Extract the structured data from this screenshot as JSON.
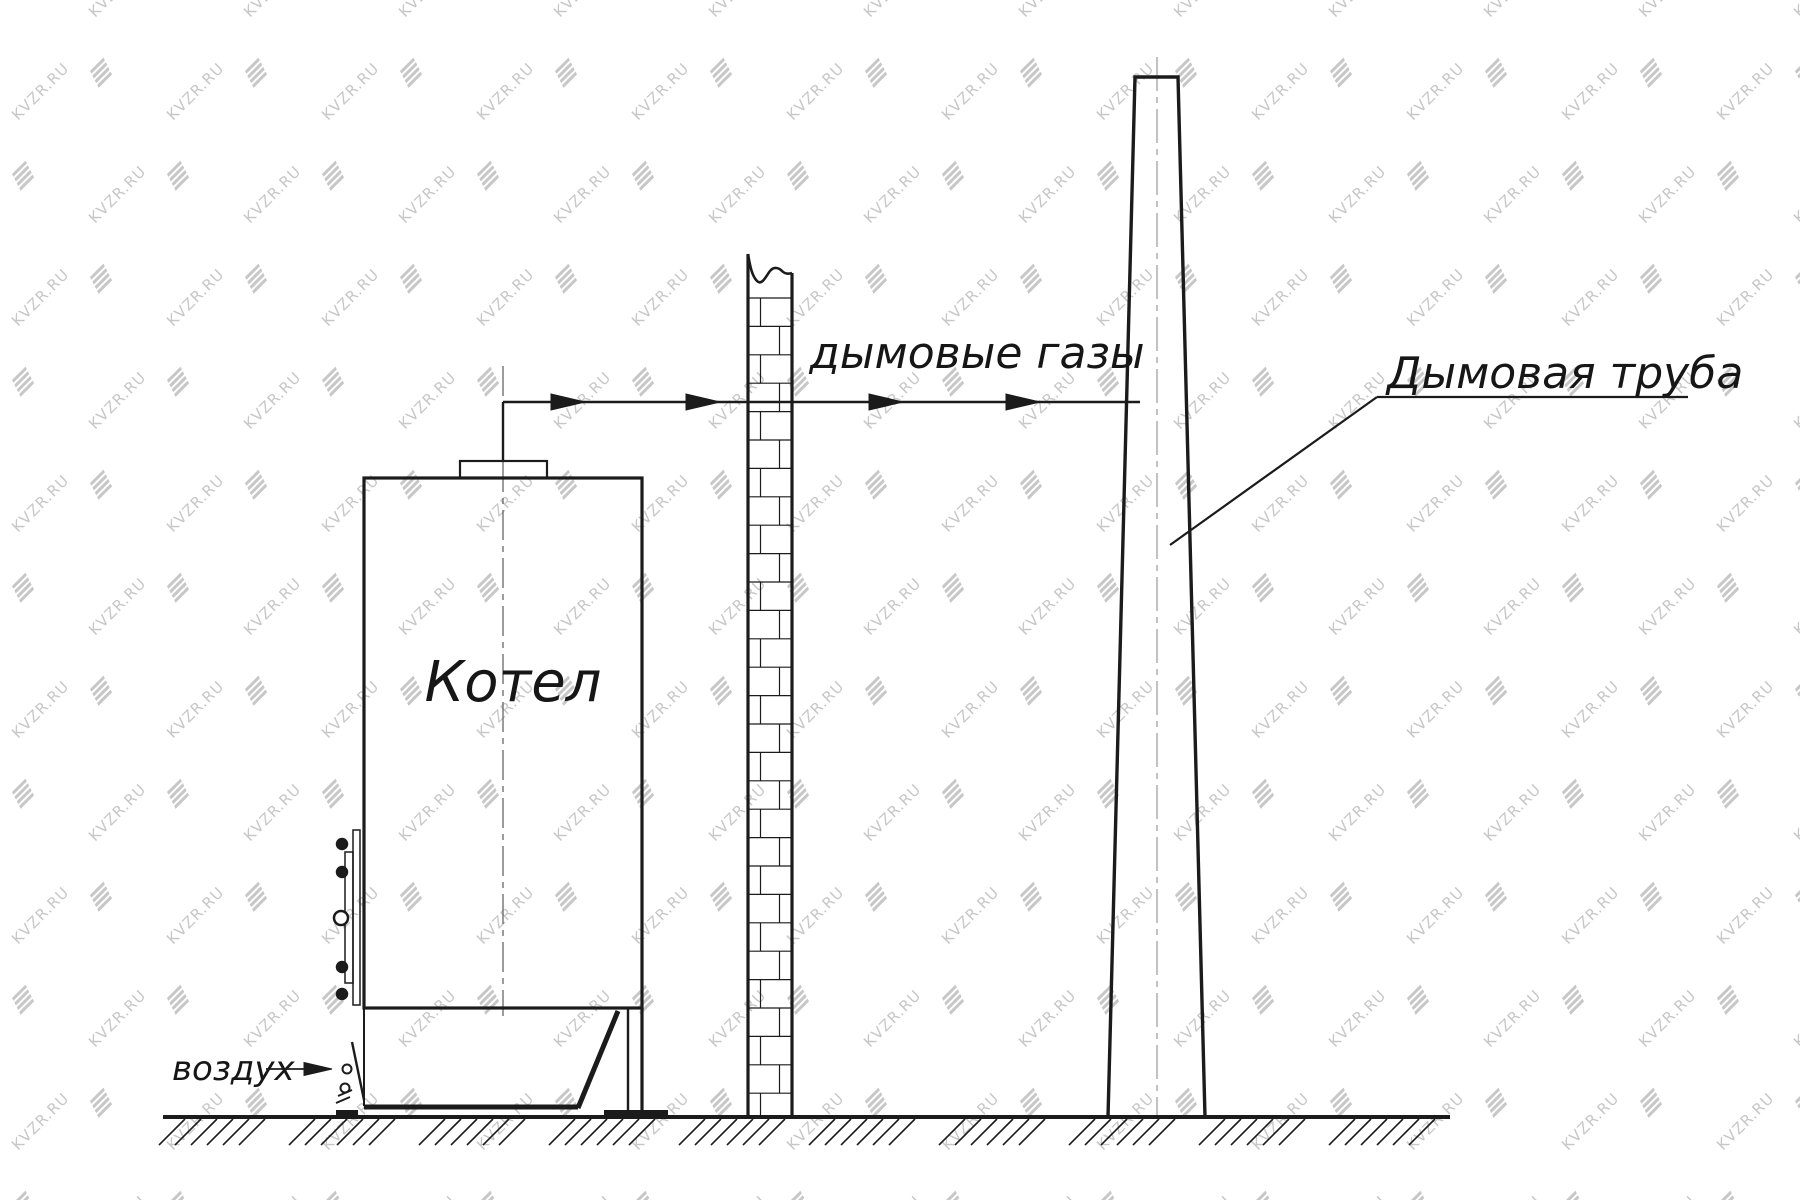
{
  "watermark": {
    "text": "KVZR.RU",
    "color": "#c7c7c7"
  },
  "labels": {
    "boiler": "Котел",
    "smoke_gases": "дымовые газы",
    "chimney": "Дымовая труба",
    "air": "воздух"
  },
  "colors": {
    "line": "#1b1b1b",
    "boiler_centerline": "#5a5a5a",
    "chimney_centerline": "#a9a9a9"
  }
}
